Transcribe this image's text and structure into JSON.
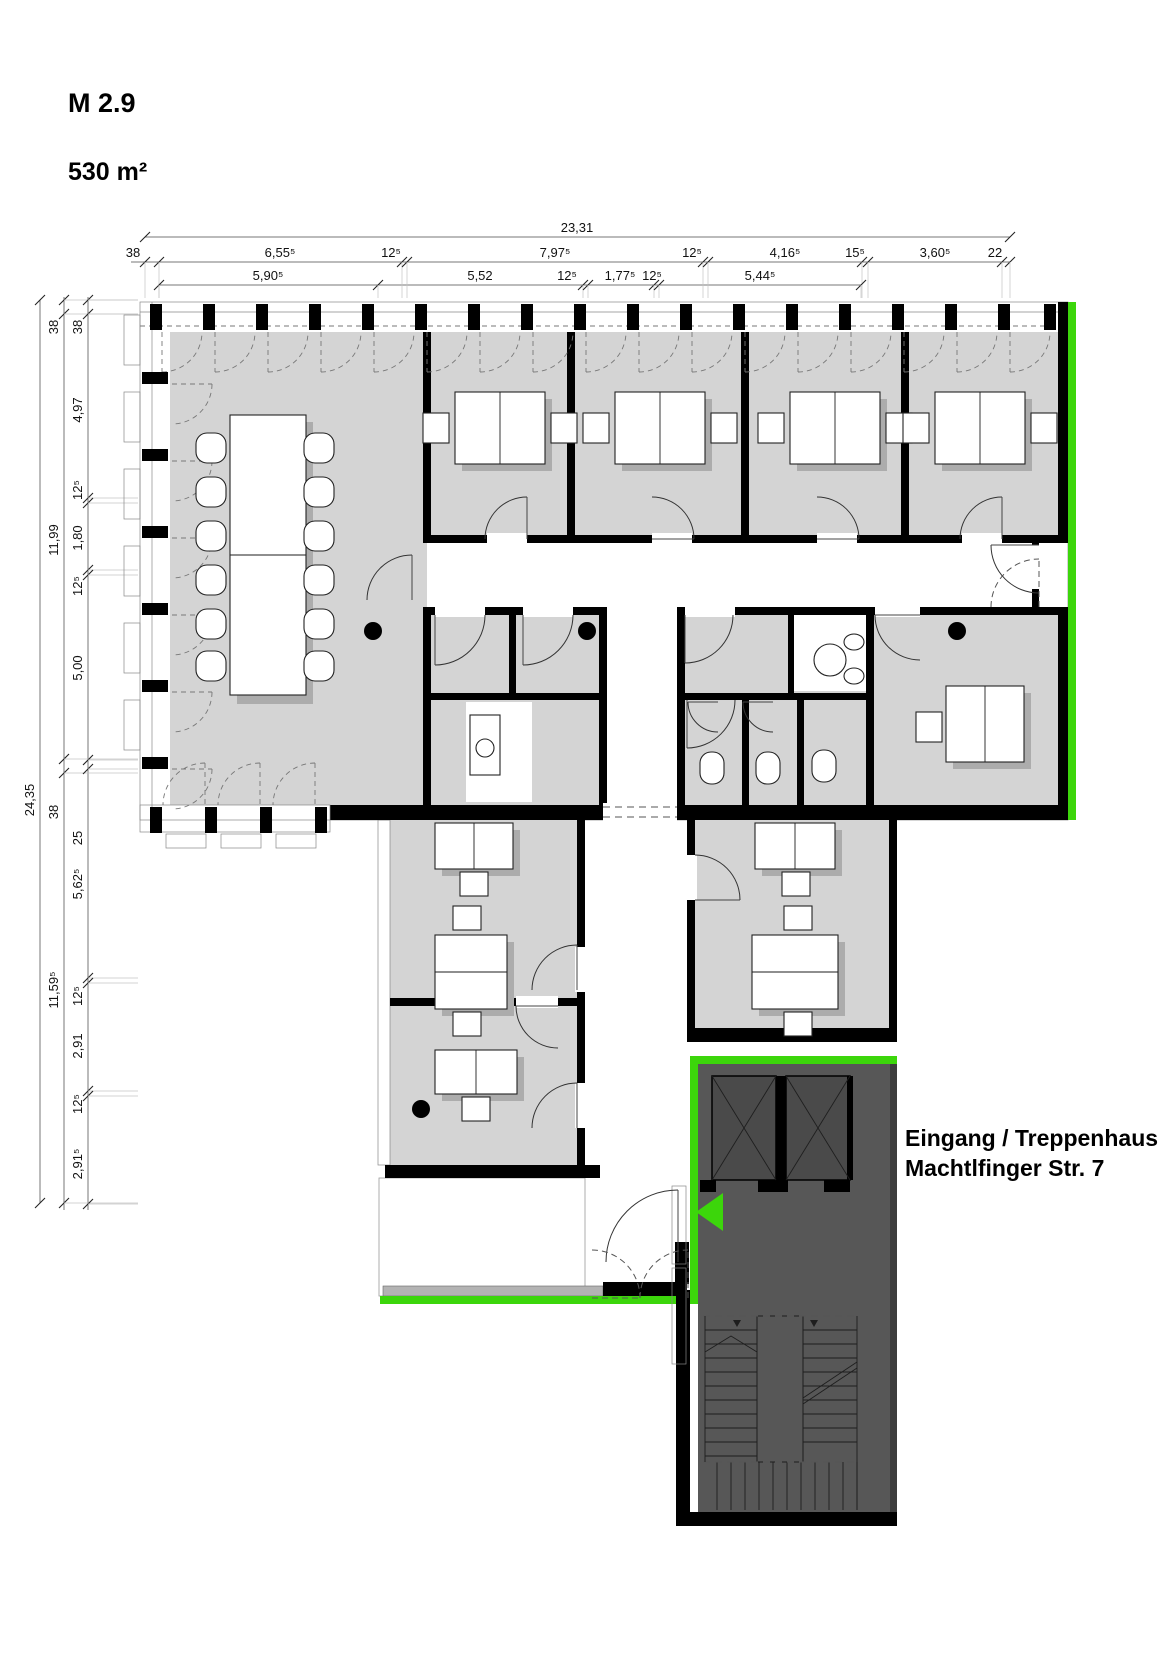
{
  "title": "M 2.9",
  "area_label": "530 m²",
  "entrance_label": {
    "line1": "Eingang / Treppenhaus",
    "line2": "Machtlfinger Str. 7"
  },
  "colors": {
    "accent_green": "#3CD60B",
    "room_fill": "#D4D4D4",
    "dark_fill": "#575757",
    "shaft_fill": "#4A4A4A",
    "shadow": "#ACACAC",
    "wall": "#000000"
  },
  "dimensions": {
    "top": {
      "total": "23,31",
      "row2": [
        "38",
        "6,55⁵",
        "12⁵",
        "7,97⁵",
        "12⁵",
        "4,16⁵",
        "15⁵",
        "3,60⁵",
        "22"
      ],
      "row3": [
        "5,90⁵",
        "5,52",
        "12⁵",
        "1,77⁵",
        "12⁵",
        "5,44⁵"
      ]
    },
    "left": {
      "total": "24,35",
      "chain_b": [
        "38",
        "11,99",
        "38",
        "11,59⁵"
      ],
      "chain_c": [
        "38",
        "4,97",
        "12⁵",
        "1,80",
        "12⁵",
        "5,00",
        "25",
        "5,62⁵",
        "12⁵",
        "2,91",
        "12⁵",
        "2,91⁵"
      ]
    }
  }
}
